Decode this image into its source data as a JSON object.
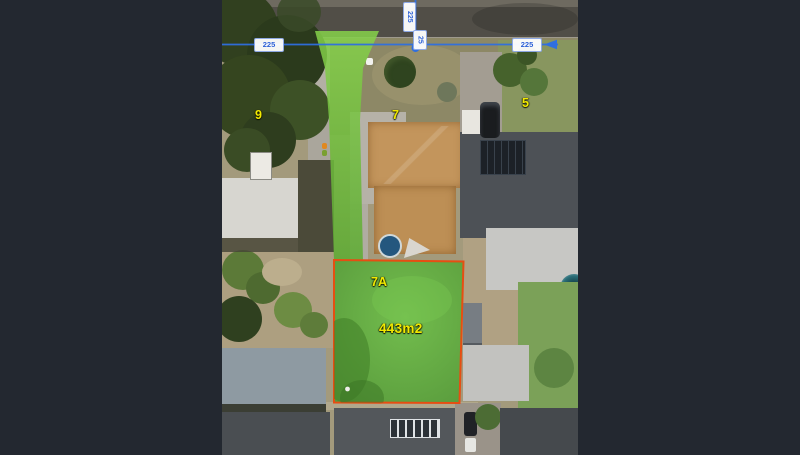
{
  "window": {
    "bg_color": "#232830"
  },
  "photo": {
    "description": "aerial-view-of-residential-lots-with-highlighted-subdivision",
    "labels": {
      "lot_9": "9",
      "lot_7": "7",
      "lot_5": "5",
      "lot_7a": "7A",
      "lot_area": "443m2",
      "label_color": "#f2ea00"
    },
    "measurement": {
      "line_color": "#2f6fe0",
      "h_label_left": "225",
      "h_label_right": "225",
      "v_label_top": "225",
      "v_label_bottom": "25",
      "text_color": "#2a5fd6"
    },
    "highlight": {
      "strip_color": "#6fc33c",
      "lot_fill": "#5bb238",
      "lot_border": "#e64e12"
    }
  }
}
